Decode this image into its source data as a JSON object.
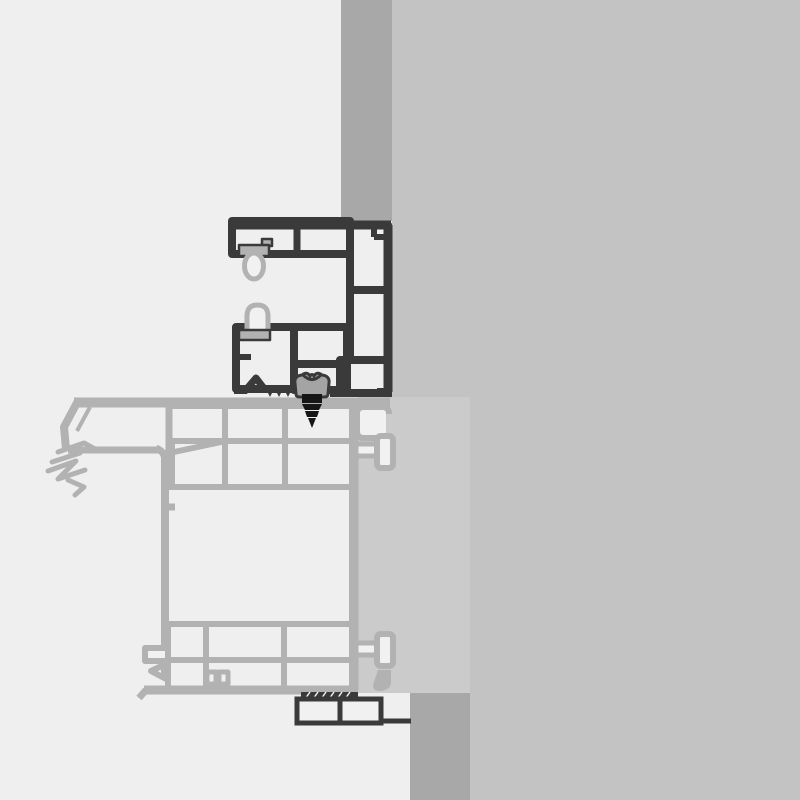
{
  "diagram": {
    "type": "cad-cross-section",
    "description": "Technical cross-section detail of a window frame fixed to a wall: dark outlined frame profile with gaskets and fixing screw, light gray sash/sill profile with glazing gasket, thermal-break connectors and fastener box",
    "canvas": {
      "width": 800,
      "height": 800
    }
  },
  "colors": {
    "background": "#efefef",
    "wall": "#c3c3c3",
    "wall_edge": "#a8a8a8",
    "filler_block": "#cbcbcb",
    "frame_line": "#3a3a3a",
    "sash_line": "#b2b2b2",
    "cell_fill": "#f1f1f1",
    "gasket": "#b2b2b2",
    "screw_head": "#a4a4a4",
    "screw_dark": "#161616"
  },
  "components": [
    {
      "id": "wall",
      "label": "wall"
    },
    {
      "id": "wall-reveal-strip-top",
      "label": "wall reveal strip (top)"
    },
    {
      "id": "wall-reveal-strip-bottom",
      "label": "wall reveal strip (bottom)"
    },
    {
      "id": "filler-block",
      "label": "filler / insulation block"
    },
    {
      "id": "frame-profile",
      "label": "frame profile (dark outline)"
    },
    {
      "id": "sash-profile",
      "label": "sash / sill profile (gray outline)"
    },
    {
      "id": "gasket-upper",
      "label": "upper bulb gasket"
    },
    {
      "id": "gasket-lower",
      "label": "lower arch gasket"
    },
    {
      "id": "glazing-gasket",
      "label": "glazing gasket claw"
    },
    {
      "id": "thermal-break-upper",
      "label": "upper thermal break T-connector"
    },
    {
      "id": "thermal-break-lower",
      "label": "lower thermal break T-connector"
    },
    {
      "id": "fixing-screw",
      "label": "fixing screw"
    },
    {
      "id": "fastener-box",
      "label": "fastener box / packer"
    }
  ]
}
